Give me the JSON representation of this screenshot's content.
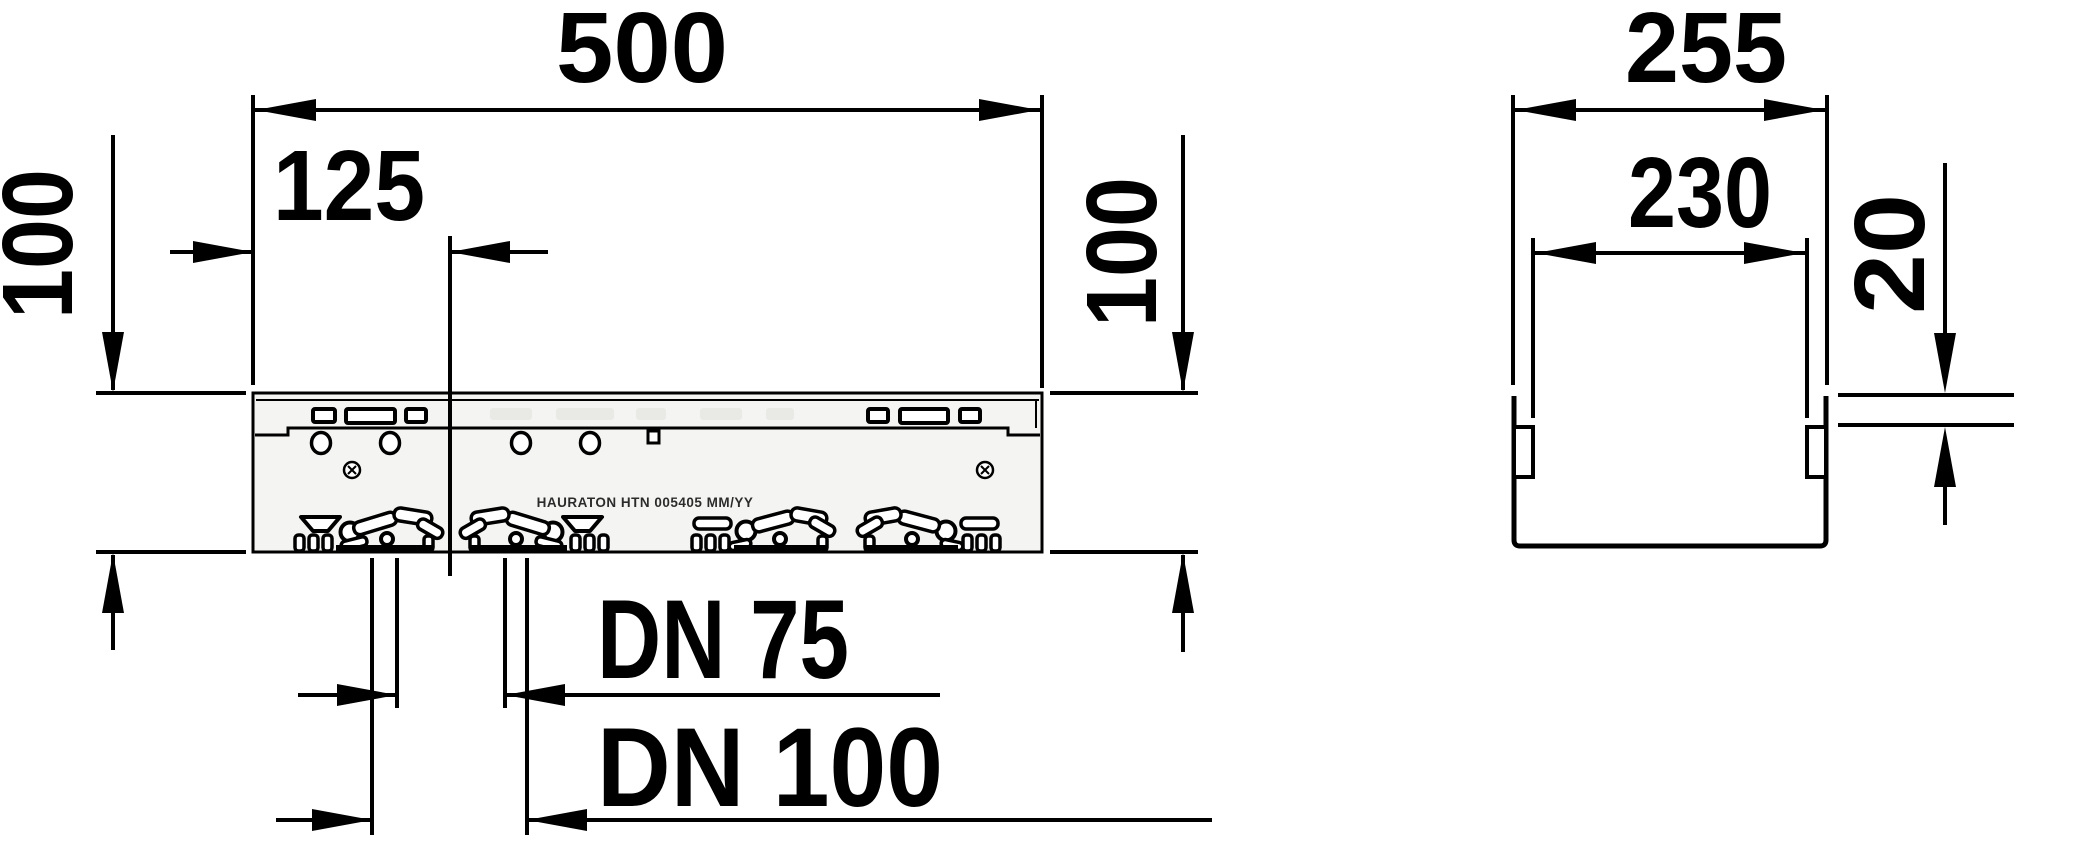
{
  "title": "Drainage channel dimension drawing",
  "colors": {
    "line": "#000000",
    "body_fill": "#f4f4f2",
    "background": "#ffffff",
    "slot_fill": "#e9e9e6"
  },
  "views": {
    "front": {
      "label_500": "500",
      "label_125": "125",
      "label_100_left": "100",
      "label_100_right": "100",
      "label_dn75": "DN 75",
      "label_dn100": "DN 100",
      "body_marking": "HAURATON HTN 005405 MM/YY"
    },
    "section": {
      "label_255": "255",
      "label_230": "230",
      "label_20": "20"
    }
  },
  "dimensions_mm": {
    "front_overall_length": 500,
    "front_outlet_offset": 125,
    "front_height_left": 100,
    "front_height_right": 100,
    "front_outlet_small": "DN 75",
    "front_outlet_large": "DN 100",
    "section_overall_width": 255,
    "section_inner_width": 230,
    "section_edge_depth": 20
  }
}
